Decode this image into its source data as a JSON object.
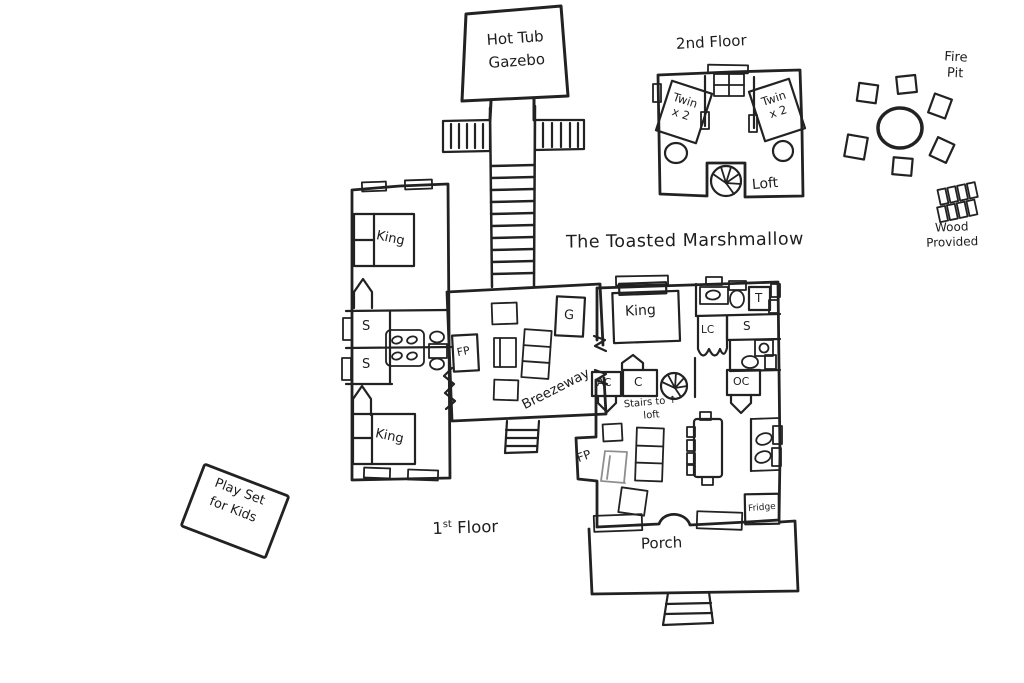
{
  "canvas": {
    "ink": "#222222",
    "paper": "#ffffff"
  },
  "title": "The Toasted Marshmallow",
  "outdoor": {
    "hot_tub_gazebo_label": "Hot Tub\nGazebo",
    "fire_pit_label": "Fire\nPit",
    "wood_provided_label": "Wood\nProvided",
    "play_set_label": "Play Set\nfor Kids",
    "porch_label": "Porch"
  },
  "second_floor": {
    "heading": "2nd Floor",
    "twin_left_label": "Twin\nx 2",
    "twin_right_label": "Twin\nx 2",
    "loft_label": "Loft"
  },
  "first_floor": {
    "heading_number": "1",
    "heading_suffix": "st",
    "heading_word": " Floor",
    "king_northwest_label": "King",
    "king_southwest_label": "King",
    "king_primary_label": "King",
    "shower_upper_label": "S",
    "shower_lower_label": "S",
    "shower_bath_label": "S",
    "tub_label": "T",
    "linen_closet_label": "LC",
    "ac_closet_label": "AC",
    "closet_label": "C",
    "owner_closet_label": "OC",
    "game_cabinet_label": "G",
    "breezeway_label": "Breezeway",
    "stairs_to_loft_label": "Stairs to ↑\nloft",
    "fireplace_breezeway_label": "FP",
    "fireplace_living_label": "FP",
    "fridge_label": "Fridge"
  }
}
